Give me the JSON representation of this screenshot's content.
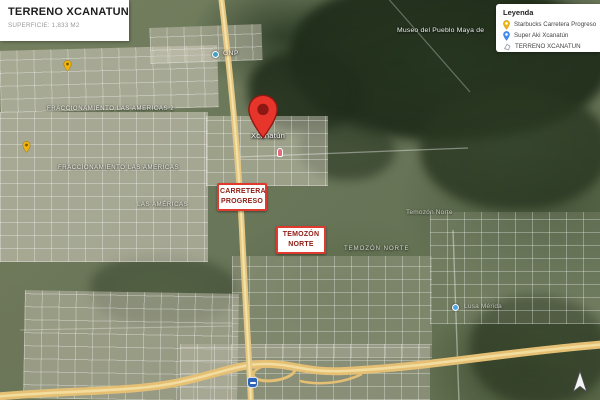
{
  "title_box": {
    "title": "TERRENO XCANATUN",
    "subtitle": "SUPERFICIE: 1,833 M2"
  },
  "legend": {
    "title": "Leyenda",
    "items": [
      {
        "label": "Starbucks Carretera Progreso",
        "icon": "yellow-pin",
        "color": "#F2B50E"
      },
      {
        "label": "Super Aki Xcanatún",
        "icon": "blue-pin",
        "color": "#3E8DF5"
      },
      {
        "label": "TERRENO XCANATUN",
        "icon": "polygon-outline",
        "color": "#9aa0a6"
      }
    ]
  },
  "marker": {
    "label": "Xcanatún",
    "color": "#E8352B"
  },
  "callouts": [
    {
      "line1": "CARRETERA",
      "line2": "PROGRESO"
    },
    {
      "line1": "TEMOZÓN",
      "line2": "NORTE"
    }
  ],
  "map_labels": [
    {
      "text": "FRACCIONAMIENTO LAS AMERICAS 2"
    },
    {
      "text": "FRACCIONAMIENTO LAS AMERICAS"
    },
    {
      "text": "LAS AMÉRICAS"
    },
    {
      "text": "TEMOZÓN NORTE"
    },
    {
      "text": "Temozón Norte"
    },
    {
      "text": "Museo del Pueblo Maya de"
    },
    {
      "text": "GNP"
    },
    {
      "text": "Lusa Mérida"
    }
  ],
  "colors": {
    "callout_border": "#E03A2F",
    "callout_text": "#8E1B12",
    "marker_red": "#E8352B",
    "highway_yellow": "#E5C074"
  }
}
